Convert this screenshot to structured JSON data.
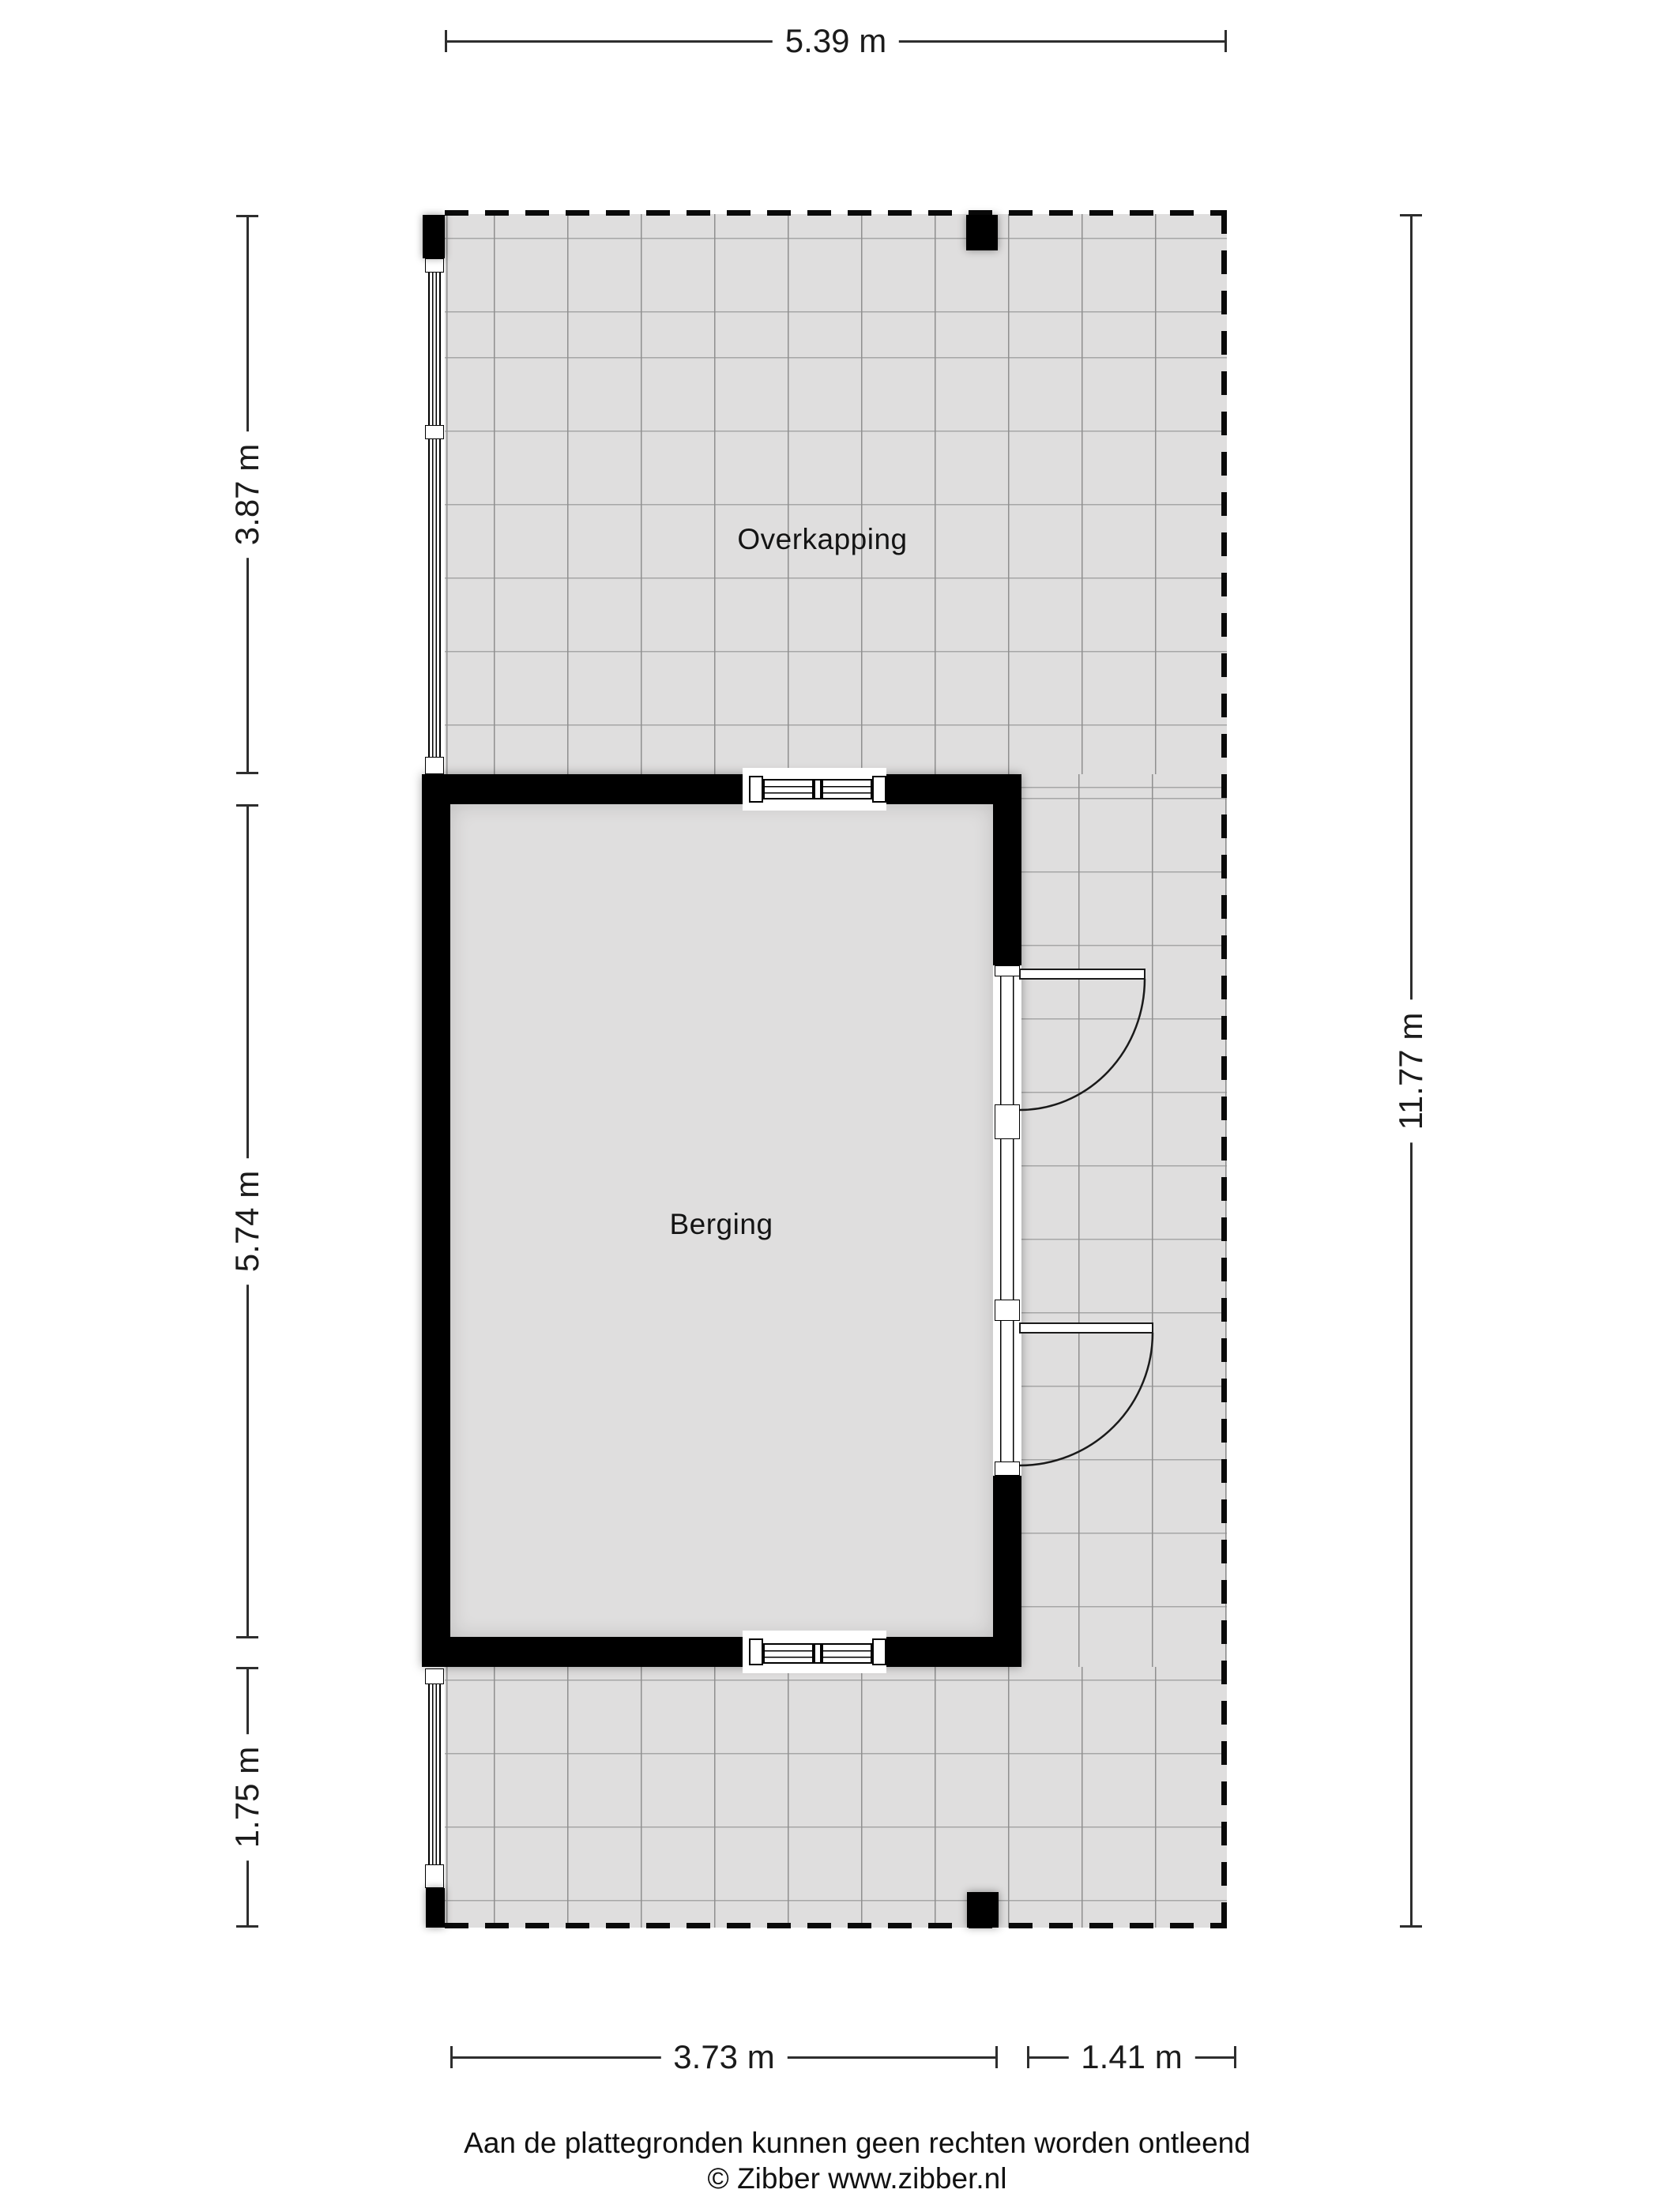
{
  "plan": {
    "rooms": [
      {
        "name": "Overkapping"
      },
      {
        "name": "Berging"
      }
    ],
    "dimensions": {
      "top": {
        "label": "5.39 m"
      },
      "left": [
        {
          "label": "3.87 m"
        },
        {
          "label": "5.74 m"
        },
        {
          "label": "1.75 m"
        }
      ],
      "right": {
        "label": "11.77 m"
      },
      "bottom": [
        {
          "label": "3.73 m"
        },
        {
          "label": "1.41 m"
        }
      ]
    },
    "colors": {
      "floor": "#dfdede",
      "wall": "#000000",
      "grid_v": "#8f8f8f",
      "grid_h": "#a6a6a6",
      "dim_line": "#2e2e2e",
      "text": "#1b1b1b"
    }
  },
  "footer": {
    "disclaimer": "Aan de plattegronden kunnen geen rechten worden ontleend",
    "credit": "© Zibber www.zibber.nl"
  }
}
